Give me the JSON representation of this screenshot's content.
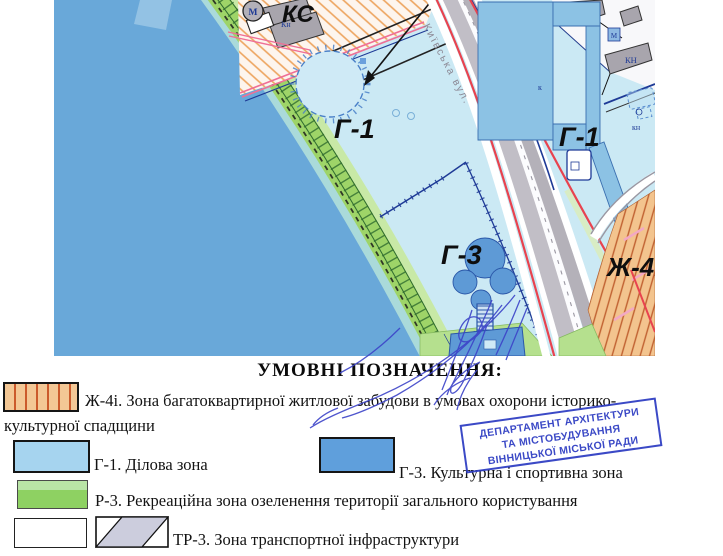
{
  "map": {
    "labels": {
      "ks": "КС",
      "g1_left": "Г-1",
      "g1_right": "Г-1",
      "g3": "Г-3",
      "zh4": "Ж-4і",
      "street": "Київська вул.",
      "metro": "М",
      "kn_top": "Кн",
      "kn_right_upper": "КН",
      "kn_right_lower": "кн",
      "k_small": "к",
      "m_small": "М"
    },
    "colors": {
      "water": "#69a8d9",
      "business_zone": "#cbe9f4",
      "green_zone": "#9ed468",
      "culture_zone": "#5e9ad6",
      "street_gray": "#b4b1b9",
      "red_line": "#e8434f",
      "pink_border": "#ef6f96",
      "navy_line": "#1e3a96",
      "hatch_orange": "#eda45e"
    }
  },
  "legend": {
    "title": "УМОВНІ ПОЗНАЧЕННЯ:",
    "items": [
      {
        "code": "Ж-4і",
        "label_line1": "Ж-4і. Зона багатоквартирної житлової забудови в умовах охорони історико-",
        "label_line2": "культурної спадщини"
      },
      {
        "code": "Г-1",
        "label": "Г-1. Ділова зона"
      },
      {
        "code": "Г-3",
        "label": "Г-3. Культурна і спортивна зона"
      },
      {
        "code": "Р-3",
        "label": "Р-3. Рекреаційна зона озеленення території загального користування"
      },
      {
        "code": "ТР-3",
        "label": "ТР-3. Зона транспортної інфраструктури"
      }
    ]
  },
  "stamp": {
    "line1": "ДЕПАРТАМЕНТ АРХІТЕКТУРИ",
    "line2": "ТА МІСТОБУДУВАННЯ",
    "line3": "ВІННИЦЬКОЇ МІСЬКОЇ РАДИ"
  }
}
